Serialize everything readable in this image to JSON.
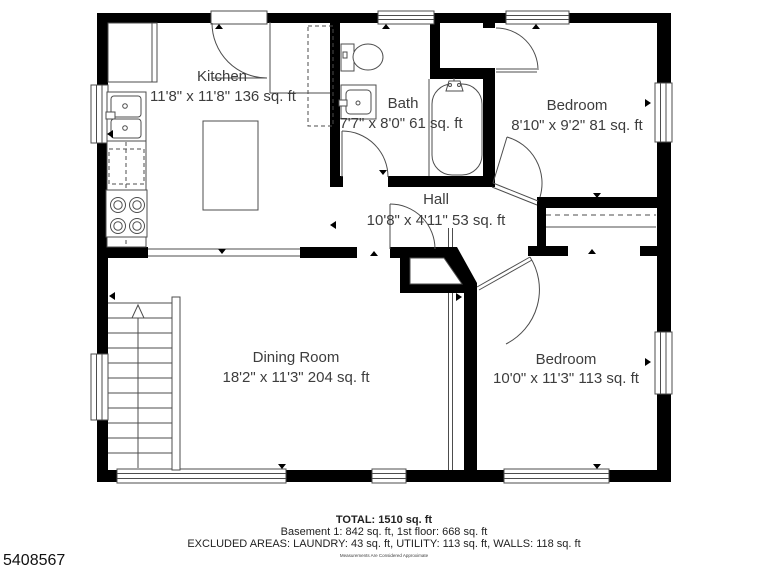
{
  "rooms": [
    {
      "name": "Kitchen",
      "dims": "11'8\" x 11'8\" 136 sq. ft"
    },
    {
      "name": "Bath",
      "dims": "7'7\" x 8'0\" 61 sq. ft"
    },
    {
      "name": "Bedroom",
      "dims": "8'10\" x 9'2\" 81 sq. ft"
    },
    {
      "name": "Hall",
      "dims": "10'8\" x 4'11\" 53 sq. ft"
    },
    {
      "name": "Dining Room",
      "dims": "18'2\" x 11'3\" 204 sq. ft"
    },
    {
      "name": "Bedroom",
      "dims": "10'0\" x 11'3\" 113 sq. ft"
    }
  ],
  "footer": {
    "total": "TOTAL: 1510 sq. ft",
    "floors": "Basement 1: 842 sq. ft, 1st floor: 668 sq. ft",
    "excluded": "EXCLUDED AREAS: LAUNDRY: 43 sq. ft, UTILITY: 113 sq. ft, WALLS: 118 sq. ft",
    "disclaimer": "Measurements Are Considered Approximate"
  },
  "listing_id": "5408567",
  "colors": {
    "wall": "#000000",
    "fixture_line": "#4d4d4d",
    "text": "#3d3d3d",
    "background": "#ffffff"
  }
}
